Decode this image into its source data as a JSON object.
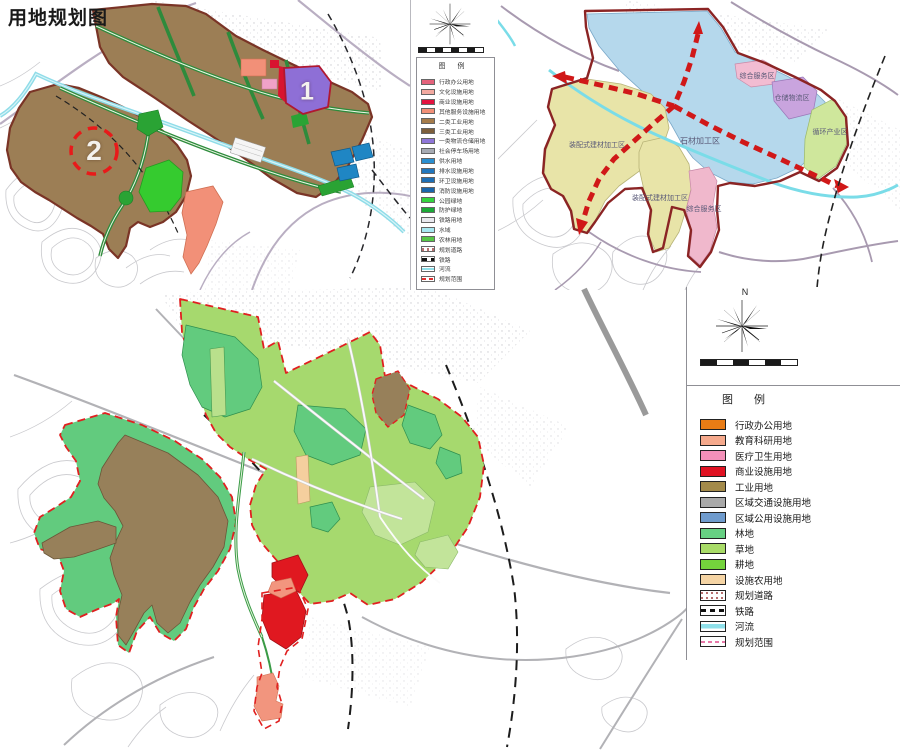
{
  "title": "用地规划图",
  "maps": {
    "topleft": {
      "markers": [
        {
          "label": "1"
        },
        {
          "label": "2"
        }
      ],
      "legend": {
        "header": "图  例",
        "items": [
          {
            "label": "行政办公用地",
            "color": "#e4637c",
            "type": "fill"
          },
          {
            "label": "文化设施用地",
            "color": "#f2a9a0",
            "type": "fill"
          },
          {
            "label": "商业设施用地",
            "color": "#e3133f",
            "type": "fill"
          },
          {
            "label": "其他服务设施用地",
            "color": "#f29078",
            "type": "fill"
          },
          {
            "label": "二类工业用地",
            "color": "#a57c4b",
            "type": "fill"
          },
          {
            "label": "三类工业用地",
            "color": "#7d5f3c",
            "type": "fill"
          },
          {
            "label": "一类物流仓储用地",
            "color": "#8f76d8",
            "type": "fill"
          },
          {
            "label": "社会停车场用地",
            "color": "#a7abb3",
            "type": "fill"
          },
          {
            "label": "供水用地",
            "color": "#2b8fd0",
            "type": "fill"
          },
          {
            "label": "排水设施用地",
            "color": "#2277bd",
            "type": "fill"
          },
          {
            "label": "环卫设施用地",
            "color": "#1f6fb5",
            "type": "fill"
          },
          {
            "label": "消防设施用地",
            "color": "#1b66ab",
            "type": "fill"
          },
          {
            "label": "公园绿地",
            "color": "#35d33f",
            "type": "fill"
          },
          {
            "label": "防护绿地",
            "color": "#1ca937",
            "type": "fill"
          },
          {
            "label": "铁路用地",
            "color": "#e9e9ef",
            "type": "fill"
          },
          {
            "label": "水域",
            "color": "#a8e9f2",
            "type": "fill"
          },
          {
            "label": "农林用地",
            "color": "#57c747",
            "type": "fill"
          },
          {
            "label": "规划道路",
            "type": "road"
          },
          {
            "label": "铁路",
            "type": "rail"
          },
          {
            "label": "河流",
            "type": "river"
          },
          {
            "label": "规划范围",
            "type": "boundary"
          }
        ]
      }
    },
    "topright": {
      "regions": [
        {
          "label": "石材加工区",
          "color": "#b5d8ec"
        },
        {
          "label": "综合服务区",
          "color": "#f2bcd2"
        },
        {
          "label": "仓储物流区",
          "color": "#c9a4de"
        },
        {
          "label": "循环产业区",
          "color": "#cfe79c"
        },
        {
          "label": "装配式建材加工区",
          "color": "#e8e4a8"
        },
        {
          "label": "装配式建材加工区",
          "color": "#e8e4a8"
        },
        {
          "label": "综合服务区",
          "color": "#f0b8cc"
        }
      ]
    },
    "bottom": {
      "compass_label": "N",
      "legend": {
        "header": "图  例",
        "items": [
          {
            "label": "行政办公用地",
            "color": "#e97c15",
            "type": "fill"
          },
          {
            "label": "教育科研用地",
            "color": "#f5a98c",
            "type": "fill"
          },
          {
            "label": "医疗卫生用地",
            "color": "#f490b9",
            "type": "fill"
          },
          {
            "label": "商业设施用地",
            "color": "#e01222",
            "type": "fill"
          },
          {
            "label": "工业用地",
            "color": "#a38a4a",
            "type": "fill"
          },
          {
            "label": "区域交通设施用地",
            "color": "#a9a9a9",
            "type": "fill"
          },
          {
            "label": "区域公用设施用地",
            "color": "#6f9bcd",
            "type": "fill"
          },
          {
            "label": "林地",
            "color": "#67d083",
            "type": "fill"
          },
          {
            "label": "草地",
            "color": "#a8db67",
            "type": "fill"
          },
          {
            "label": "耕地",
            "color": "#74d33c",
            "type": "fill"
          },
          {
            "label": "设施农用地",
            "color": "#f5d4a4",
            "type": "fill"
          },
          {
            "label": "规划道路",
            "type": "road"
          },
          {
            "label": "铁路",
            "type": "rail"
          },
          {
            "label": "河流",
            "type": "river"
          },
          {
            "label": "规划范围",
            "type": "boundary2"
          }
        ]
      }
    }
  },
  "colors": {
    "planning_boundary_red": "#e02020",
    "industrial_brown": "#97805a",
    "forest_green": "#62cb7e",
    "grass_green": "#a6d96e",
    "water_cyan": "#8fdce8",
    "corridor_red": "#d01818"
  }
}
